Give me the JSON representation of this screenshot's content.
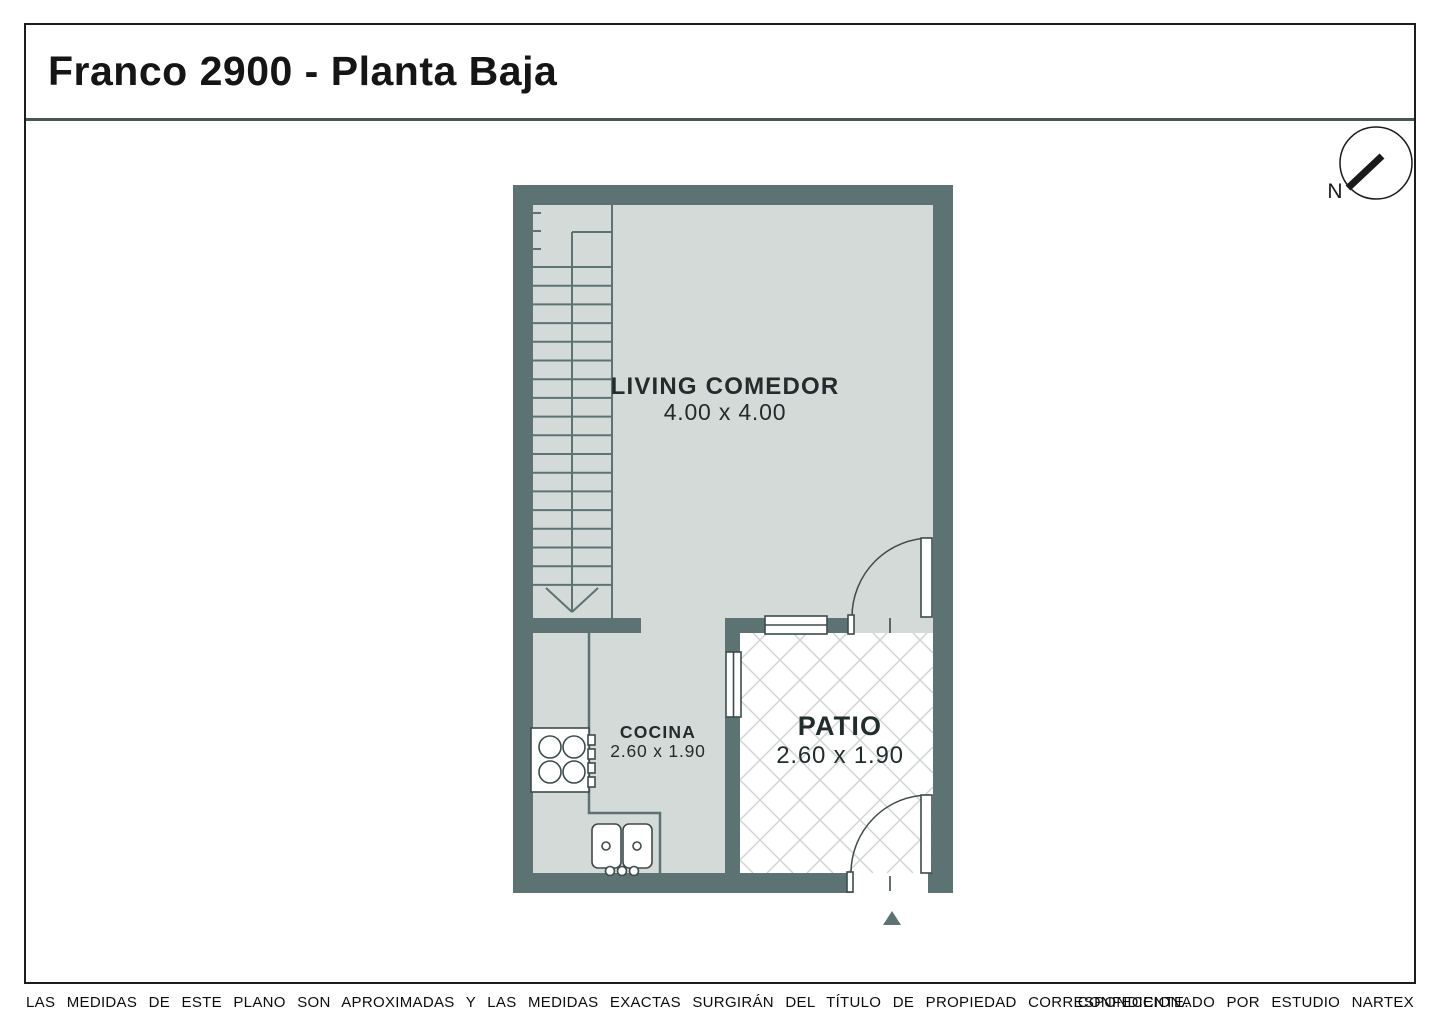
{
  "title": "Franco 2900 - Planta Baja",
  "compass": {
    "north_label": "N"
  },
  "plan": {
    "rooms": [
      {
        "id": "living",
        "name": "LIVING COMEDOR",
        "dims": "4.00 x 4.00"
      },
      {
        "id": "cocina",
        "name": "COCINA",
        "dims": "2.60 x 1.90"
      },
      {
        "id": "patio",
        "name": "PATIO",
        "dims": "2.60 x 1.90"
      }
    ],
    "features": [
      "staircase",
      "stove",
      "double-sink",
      "patio-door",
      "entrance-door",
      "windows",
      "entrance-arrow"
    ]
  },
  "footer": {
    "disclaimer": "LAS MEDIDAS DE ESTE PLANO SON APROXIMADAS Y LAS MEDIDAS EXACTAS SURGIRÁN DEL TÍTULO DE PROPIEDAD CORRESPONDIENTE.",
    "credit": "CONFECCIONADO POR ESTUDIO NARTEX"
  },
  "colors": {
    "wall": "#5d7373",
    "floor": "#d4dad8",
    "lattice": "#d0d5d4",
    "ink": "#1c1c1c",
    "line": "#3e4b4b"
  }
}
